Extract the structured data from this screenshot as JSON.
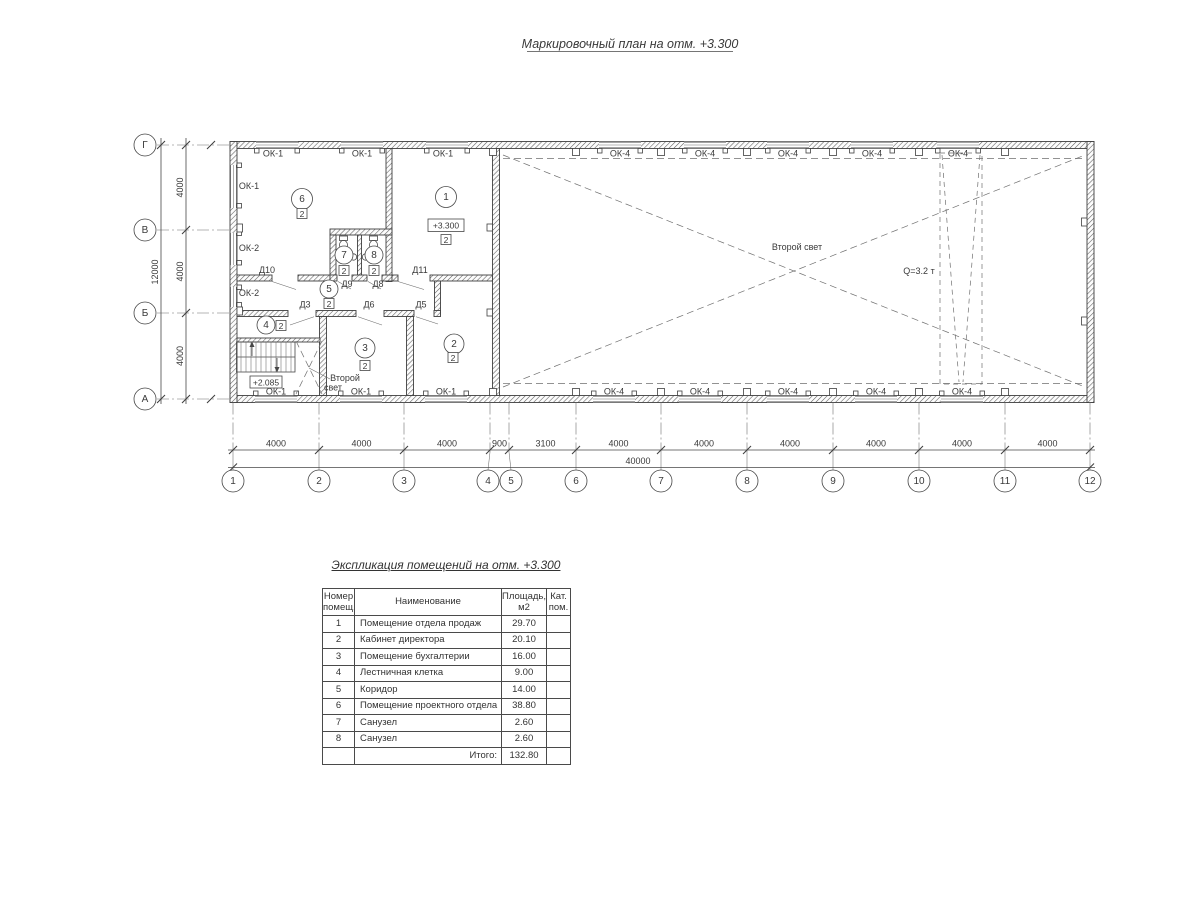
{
  "plan_title": "Маркировочный план на отм. +3.300",
  "plan": {
    "axes_left": [
      "Г",
      "В",
      "Б",
      "А"
    ],
    "axes_bottom": [
      "1",
      "2",
      "3",
      "4",
      "5",
      "6",
      "7",
      "8",
      "9",
      "10",
      "11",
      "12"
    ],
    "dims_bottom": [
      "4000",
      "4000",
      "4000",
      "900",
      "3100",
      "4000",
      "4000",
      "4000",
      "4000",
      "4000",
      "4000"
    ],
    "dim_bottom_total": "40000",
    "dims_left": [
      "4000",
      "4000",
      "4000"
    ],
    "dim_left_total": "12000",
    "window_labels": {
      "ok1": "ОК-1",
      "ok2": "ОК-2",
      "ok4": "ОК-4"
    },
    "door_labels": {
      "d3": "Д3",
      "d5": "Д5",
      "d6": "Д6",
      "d8": "Д8",
      "d9": "Д9",
      "d10": "Д10",
      "d11": "Д11"
    },
    "room_numbers": [
      "1",
      "2",
      "3",
      "4",
      "5",
      "6",
      "7",
      "8"
    ],
    "zone_mark": "2",
    "elevation_main": "+3.300",
    "elevation_stair": "+2.085",
    "second_light": "Второй свет",
    "second_light_lines": [
      "Второй",
      "свет"
    ],
    "crane_capacity": "Q=3.2 т"
  },
  "table": {
    "title": "Экспликация помещений на отм. +3.300",
    "header": {
      "num": [
        "Номер",
        "помещ."
      ],
      "name": [
        "Наименование"
      ],
      "area": [
        "Площадь,",
        "м2"
      ],
      "cat": [
        "Кат.",
        "пом."
      ]
    },
    "rows": [
      {
        "num": "1",
        "name": "Помещение отдела продаж",
        "area": "29.70",
        "cat": ""
      },
      {
        "num": "2",
        "name": "Кабинет директора",
        "area": "20.10",
        "cat": ""
      },
      {
        "num": "3",
        "name": "Помещение бухгалтерии",
        "area": "16.00",
        "cat": ""
      },
      {
        "num": "4",
        "name": "Лестничная клетка",
        "area": "9.00",
        "cat": ""
      },
      {
        "num": "5",
        "name": "Коридор",
        "area": "14.00",
        "cat": ""
      },
      {
        "num": "6",
        "name": "Помещение проектного отдела",
        "area": "38.80",
        "cat": ""
      },
      {
        "num": "7",
        "name": "Санузел",
        "area": "2.60",
        "cat": ""
      },
      {
        "num": "8",
        "name": "Санузел",
        "area": "2.60",
        "cat": ""
      }
    ],
    "total_label": "Итого:",
    "total_value": "132.80"
  }
}
